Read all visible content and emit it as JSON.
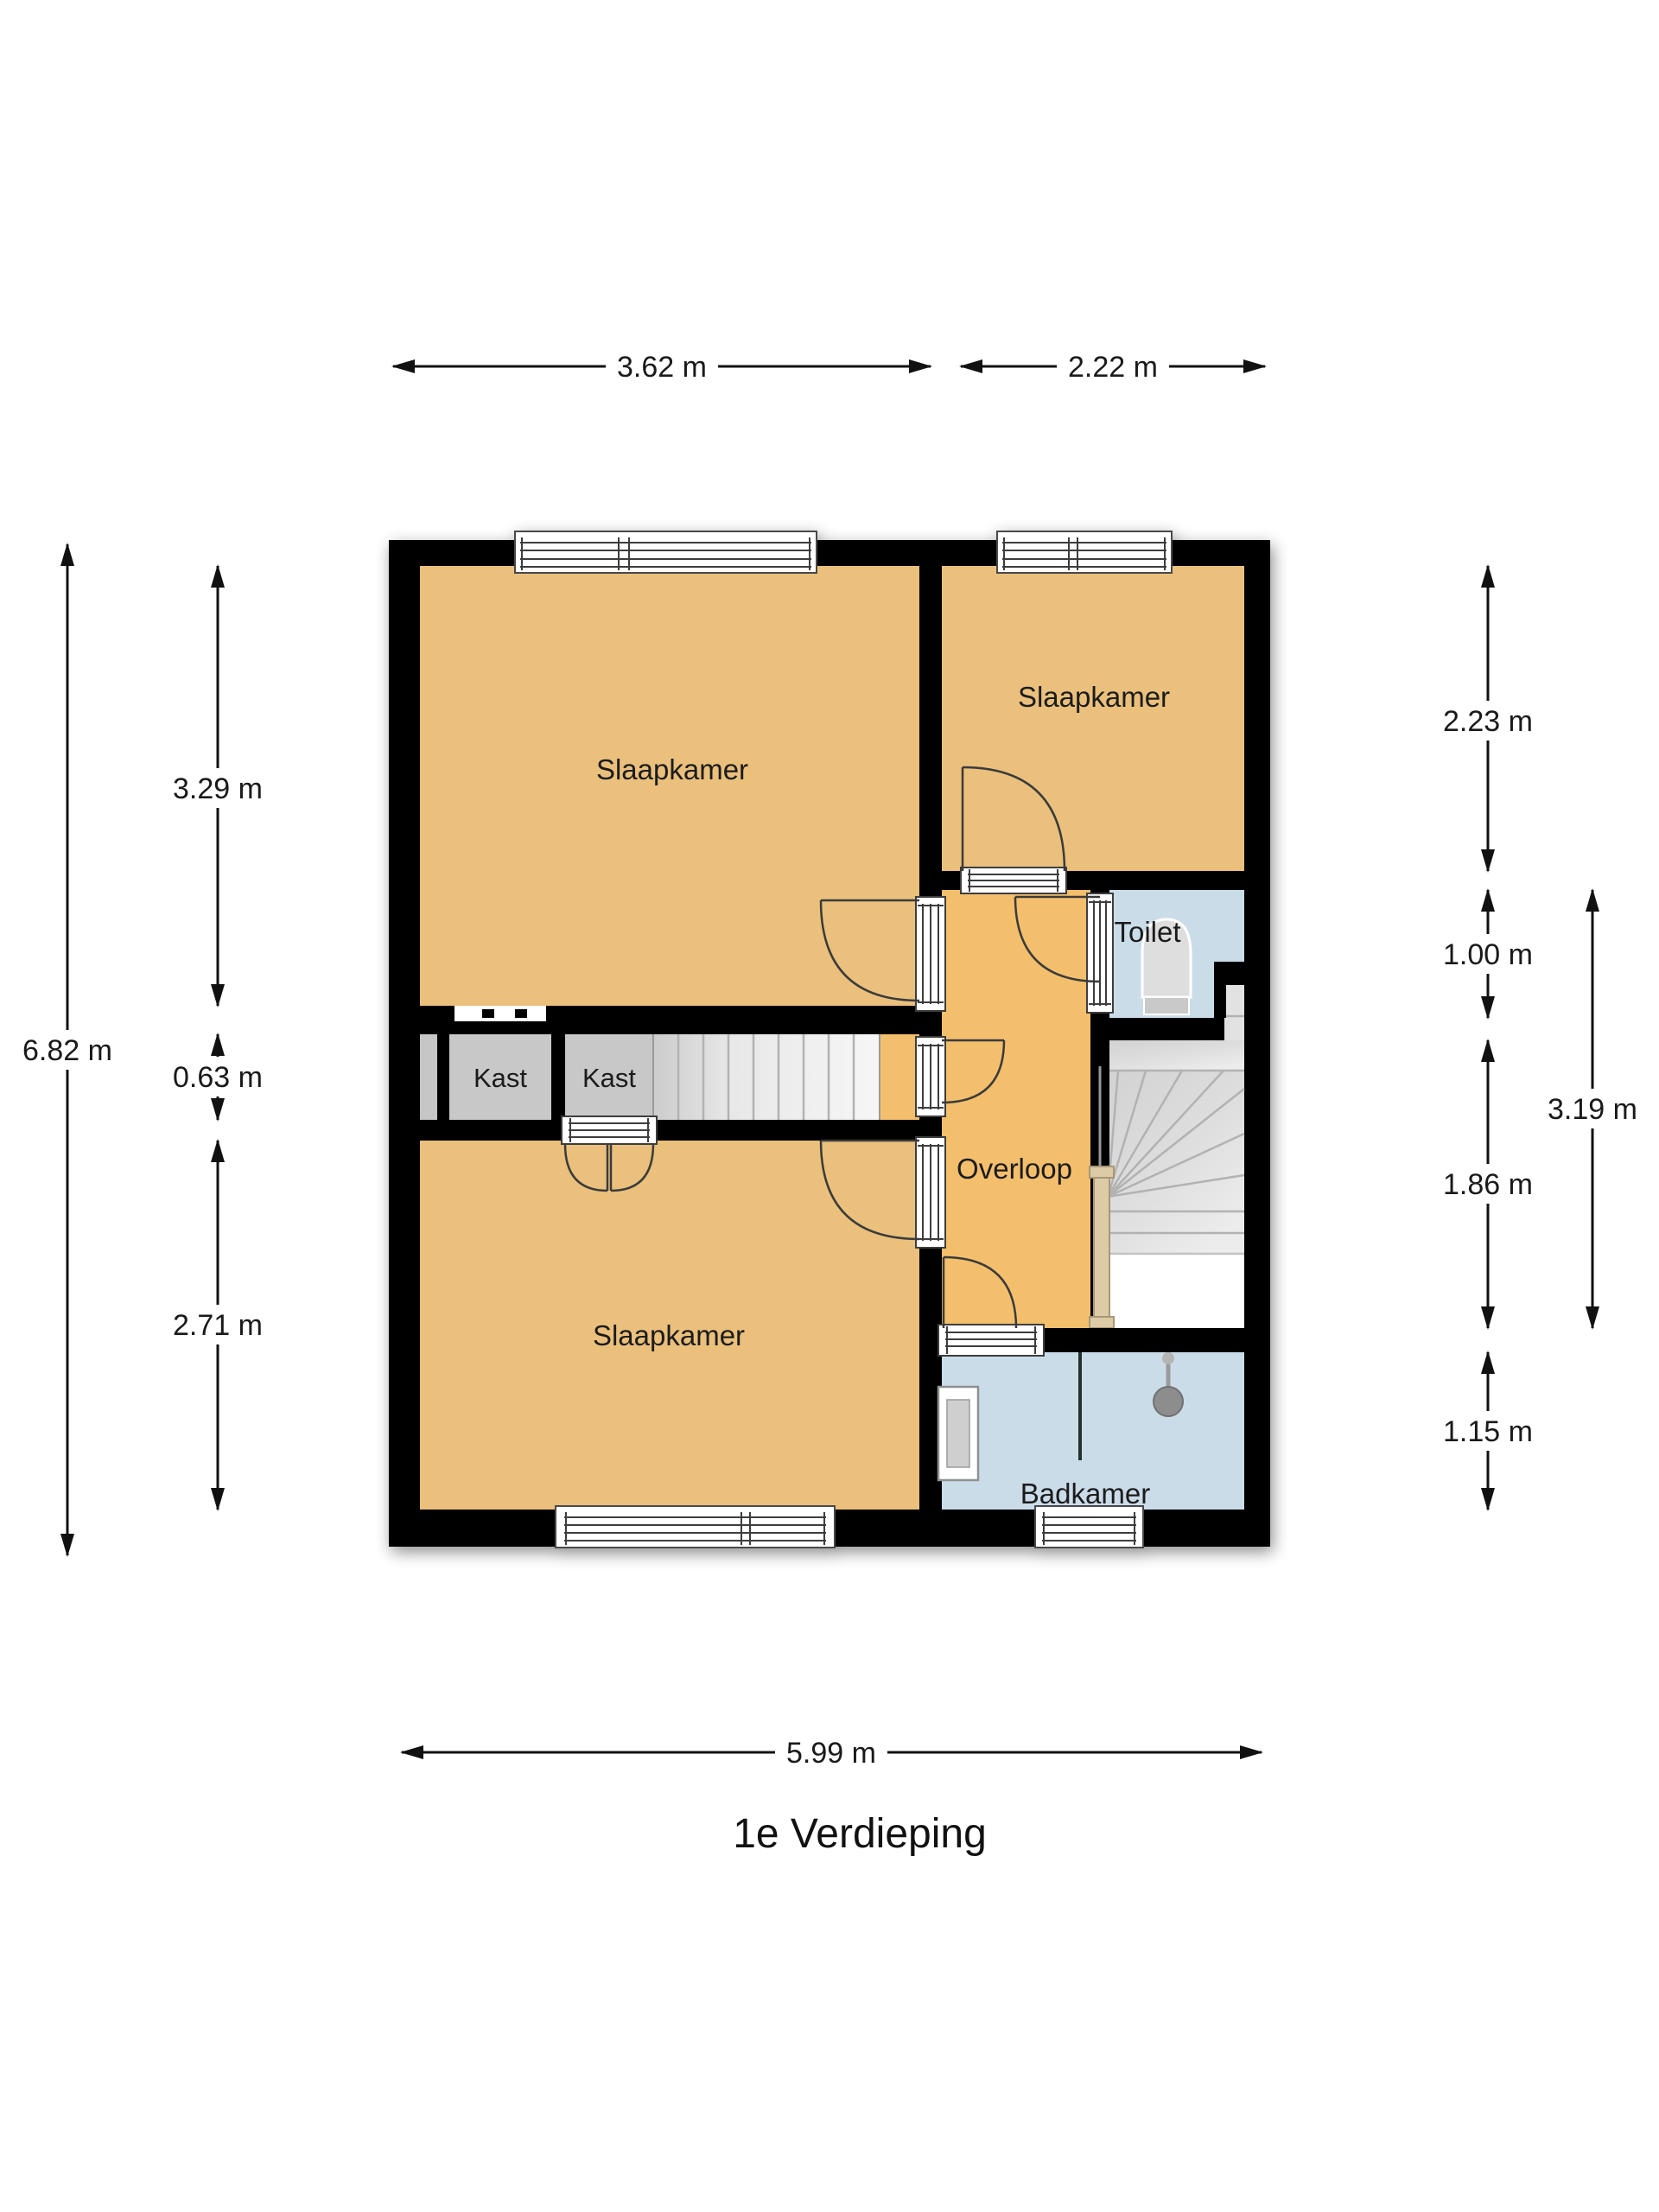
{
  "title": "1e Verdieping",
  "rooms": {
    "bedroom_top_left": {
      "label": "Slaapkamer"
    },
    "bedroom_top_right": {
      "label": "Slaapkamer"
    },
    "bedroom_bottom": {
      "label": "Slaapkamer"
    },
    "toilet": {
      "label": "Toilet"
    },
    "hallway": {
      "label": "Overloop"
    },
    "bathroom": {
      "label": "Badkamer"
    },
    "closet_left": {
      "label": "Kast"
    },
    "closet_right": {
      "label": "Kast"
    }
  },
  "dimensions": {
    "top_left_width": "3.62 m",
    "top_right_width": "2.22 m",
    "bottom_width": "5.99 m",
    "left_total_height": "6.82 m",
    "left_bedroom_top_height": "3.29 m",
    "left_closet_height": "0.63 m",
    "left_bedroom_bottom_height": "2.71 m",
    "right_bedroom_height": "2.23 m",
    "right_toilet_height": "1.00 m",
    "right_stairs_height": "1.86 m",
    "right_bathroom_height": "1.15 m",
    "right_total_height": "3.19 m"
  },
  "colors": {
    "wall": "#000000",
    "bedroom_fill": "#EAC07C",
    "hallway_fill": "#F4BF6D",
    "wet_room_fill": "#CBDCE9",
    "closet_fill": "#C8C8C8",
    "stair_light": "#E7E7E7",
    "railing_fill": "#DCCBA4"
  },
  "icons": {
    "toilet": "toilet-bowl-icon",
    "shower": "shower-head-icon",
    "radiator": "radiator-icon",
    "stairs_winder": "winder-stairs",
    "stairs_straight": "straight-stairs"
  }
}
